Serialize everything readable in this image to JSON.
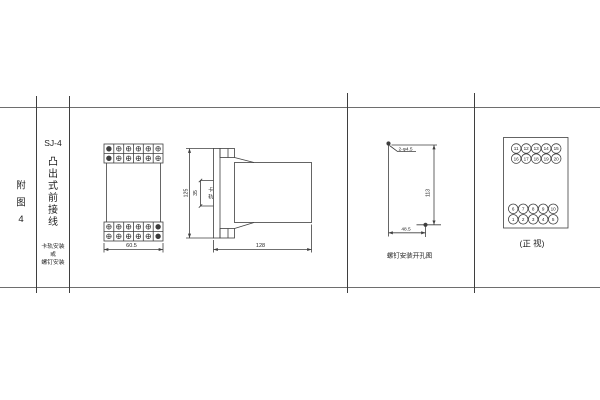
{
  "page": {
    "background": "#ffffff",
    "line_color": "#3f3f3f"
  },
  "index_column": {
    "chars": [
      "附",
      "图",
      "4"
    ]
  },
  "title_column": {
    "model": "SJ-4",
    "style_chars": [
      "凸",
      "出",
      "式",
      "前",
      "接",
      "线"
    ],
    "mounting_note_lines": [
      "卡轨安装",
      "或",
      "螺钉安装"
    ]
  },
  "front_view": {
    "width_dim": "60.5"
  },
  "side_view": {
    "height_dim": "125",
    "rail_width_dim": "35",
    "rail_label_chars": [
      "卡",
      "轨"
    ],
    "depth_dim": "128"
  },
  "drill_view": {
    "holes_label": "2-φ4.5",
    "vertical_dim": "113",
    "horizontal_dim": "48.5",
    "caption": "螺钉安装开孔图"
  },
  "terminal_view": {
    "caption": "(正 视)",
    "top_rows": [
      [
        "11",
        "12",
        "13",
        "14",
        "15"
      ],
      [
        "16",
        "17",
        "18",
        "19",
        "20"
      ]
    ],
    "bottom_rows": [
      [
        "6",
        "7",
        "8",
        "9",
        "10"
      ],
      [
        "1",
        "2",
        "3",
        "4",
        "5"
      ]
    ]
  }
}
